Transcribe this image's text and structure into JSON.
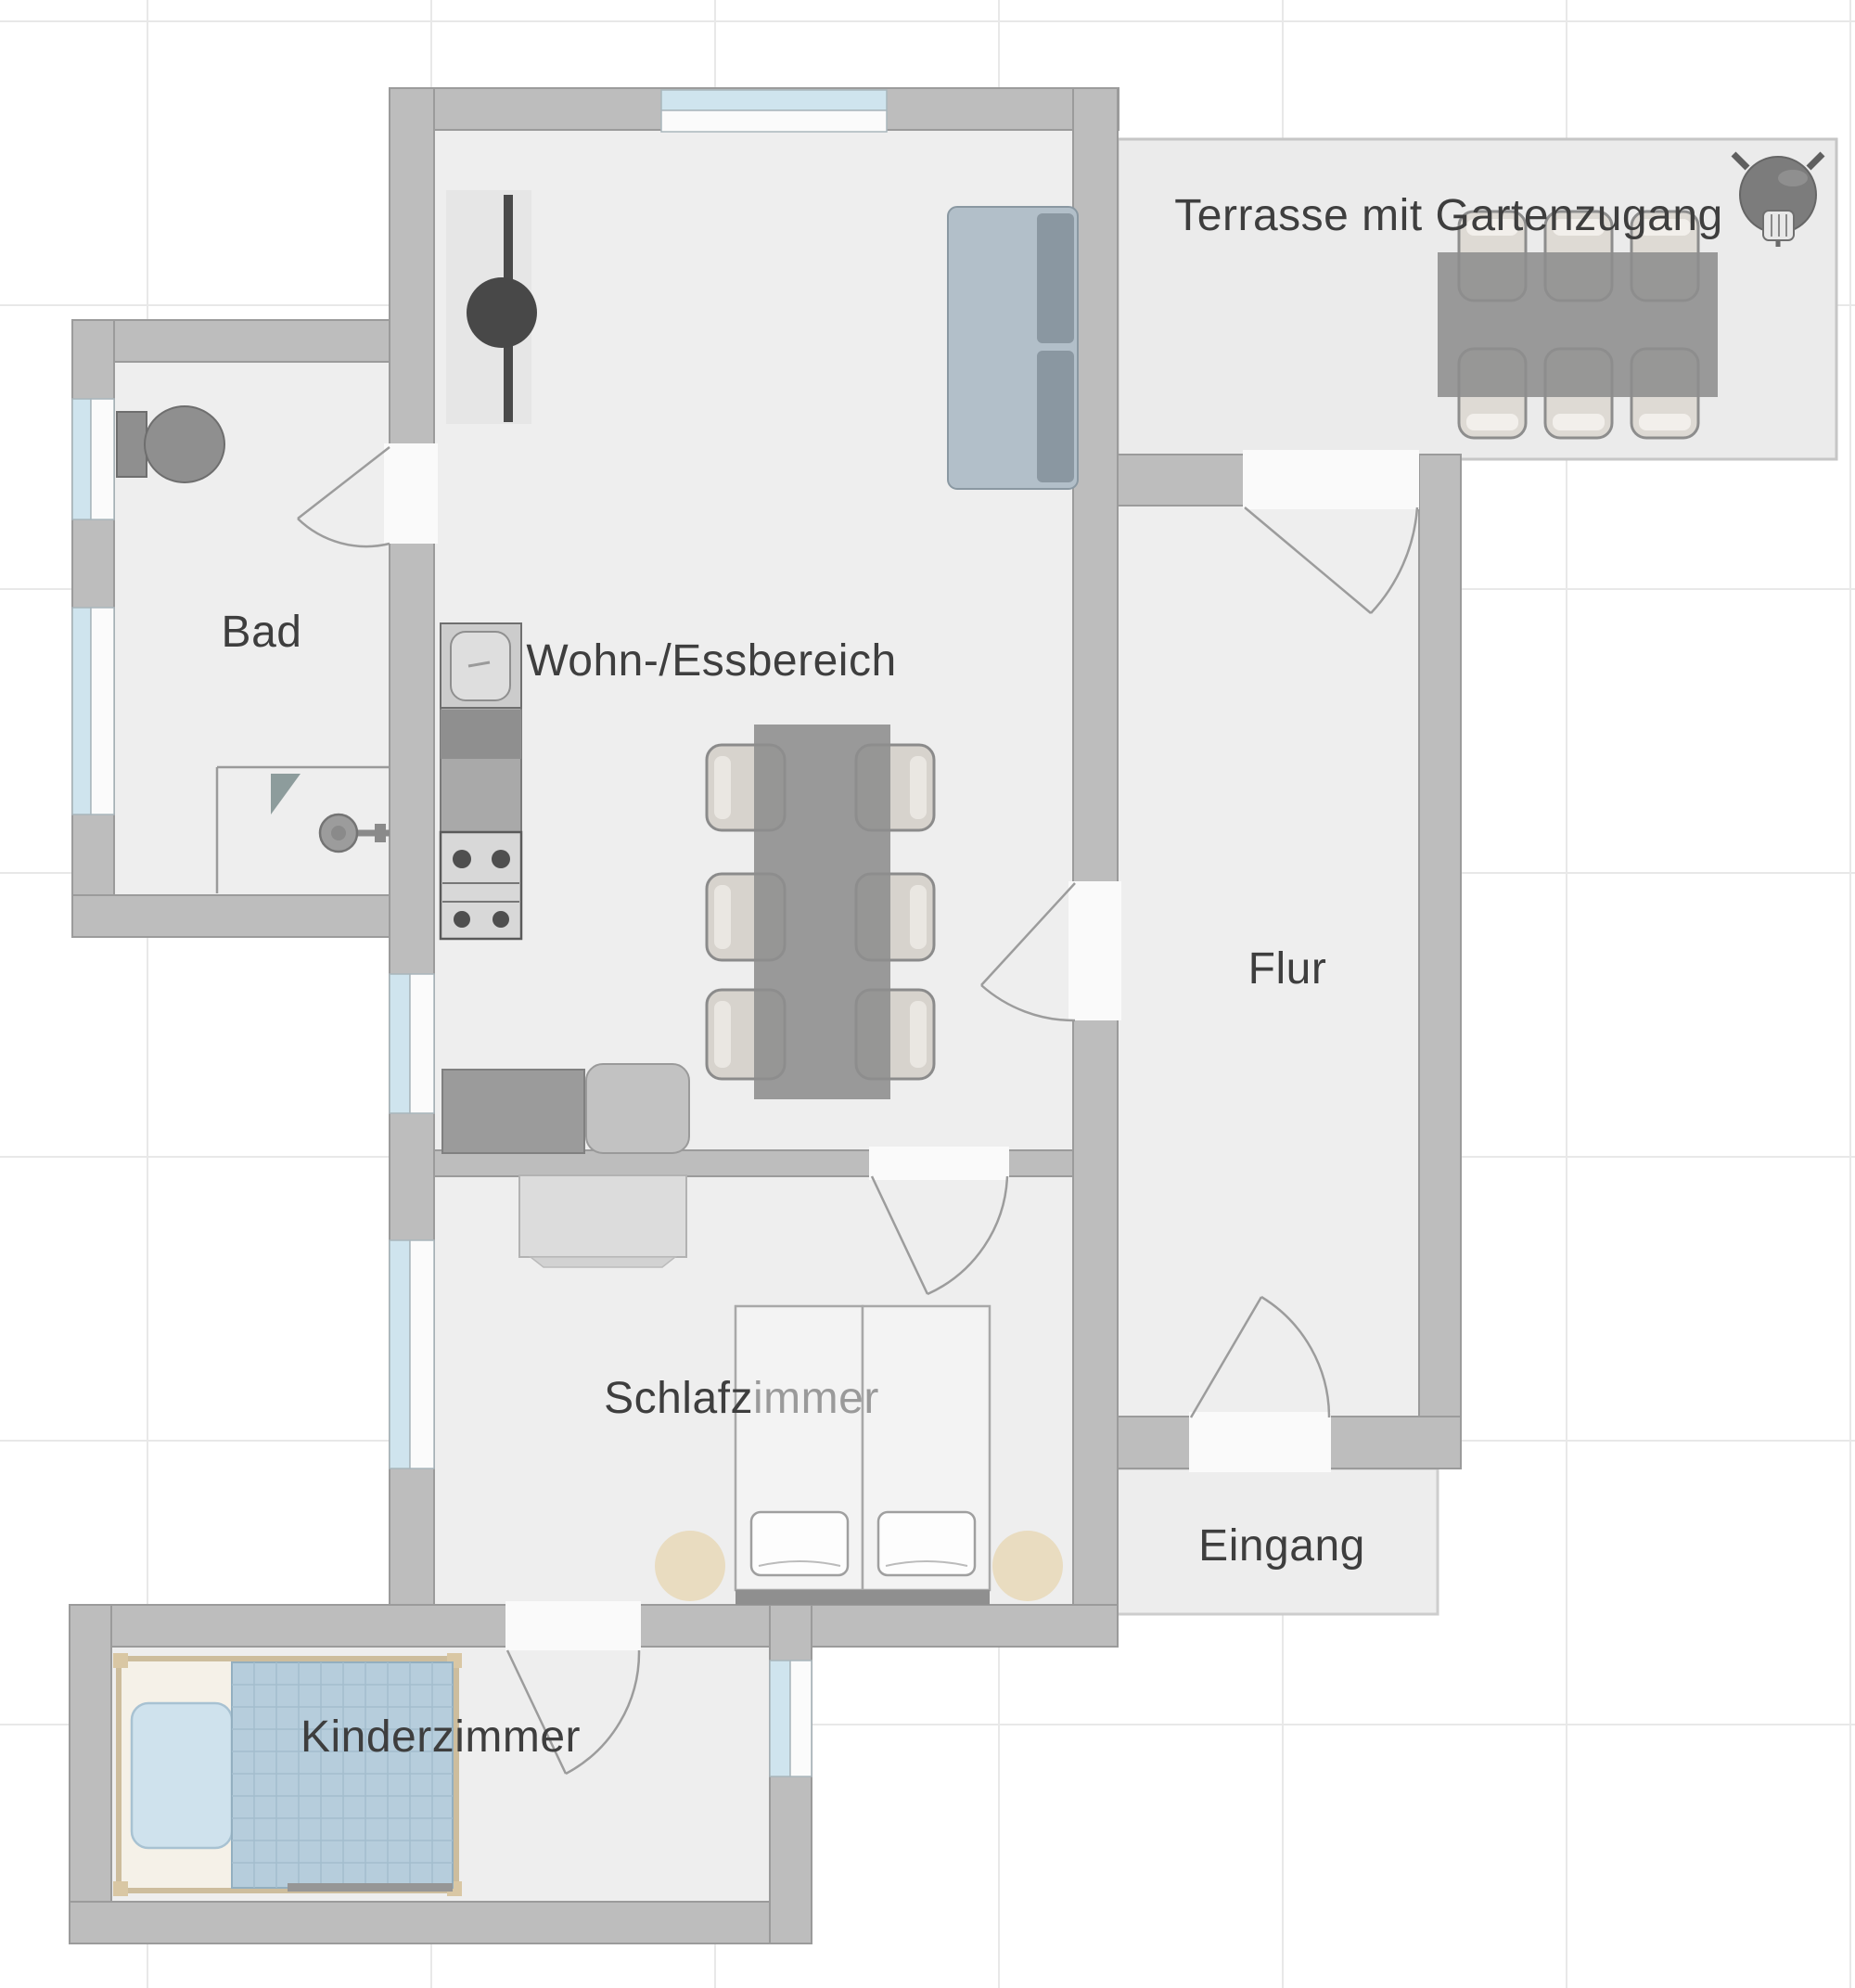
{
  "plan": {
    "type": "apartment-floor-plan",
    "rooms": {
      "terrasse": {
        "label": "Terrasse mit Gartenzugang"
      },
      "wohn": {
        "label": "Wohn-/Essbereich"
      },
      "bad": {
        "label": "Bad"
      },
      "flur": {
        "label": "Flur"
      },
      "schlafzimmer": {
        "label": "Schlafzimmer",
        "label_part_dark": "Schlafz",
        "label_part_light": "immer"
      },
      "eingang": {
        "label": "Eingang"
      },
      "kinderzimmer": {
        "label": "Kinderzimmer"
      }
    },
    "furniture_symbols": {
      "terrasse": [
        "outdoor-dining-table",
        "outdoor-chair-x6",
        "kettle-grill"
      ],
      "wohn": [
        "tv-unit",
        "sofa",
        "kitchen-sink",
        "kitchen-counter",
        "stove-4-burners",
        "dining-table",
        "dining-chair-x6",
        "sideboard",
        "armchair"
      ],
      "bad": [
        "toilet",
        "shower-enclosure",
        "shower-head"
      ],
      "schlafzimmer": [
        "wardrobe",
        "double-bed",
        "pillow-x2",
        "round-rug-x2"
      ],
      "kinderzimmer": [
        "kids-bed",
        "pillow",
        "plaid-blanket"
      ]
    },
    "colors": {
      "wall": "#bdbdbd",
      "wall_edge": "#9b9b9b",
      "floor": "#eeeeee",
      "outdoor_floor": "#ebebeb",
      "window_pane": "#cfe4ee",
      "window_frame": "#fbfbfb",
      "label_text": "#3e3e3e",
      "label_text_light": "#9a9a9a",
      "table": "#8d8d8d",
      "chair": "#d7d3cd",
      "sofa_seat": "#b2bfc9",
      "sofa_back": "#8a97a1",
      "rug_beige": "#e9dcc0",
      "kid_blanket": "#b6cddc",
      "kid_pillow": "#cfe2ed",
      "bed_frame_tan": "#d9c7a4"
    }
  }
}
